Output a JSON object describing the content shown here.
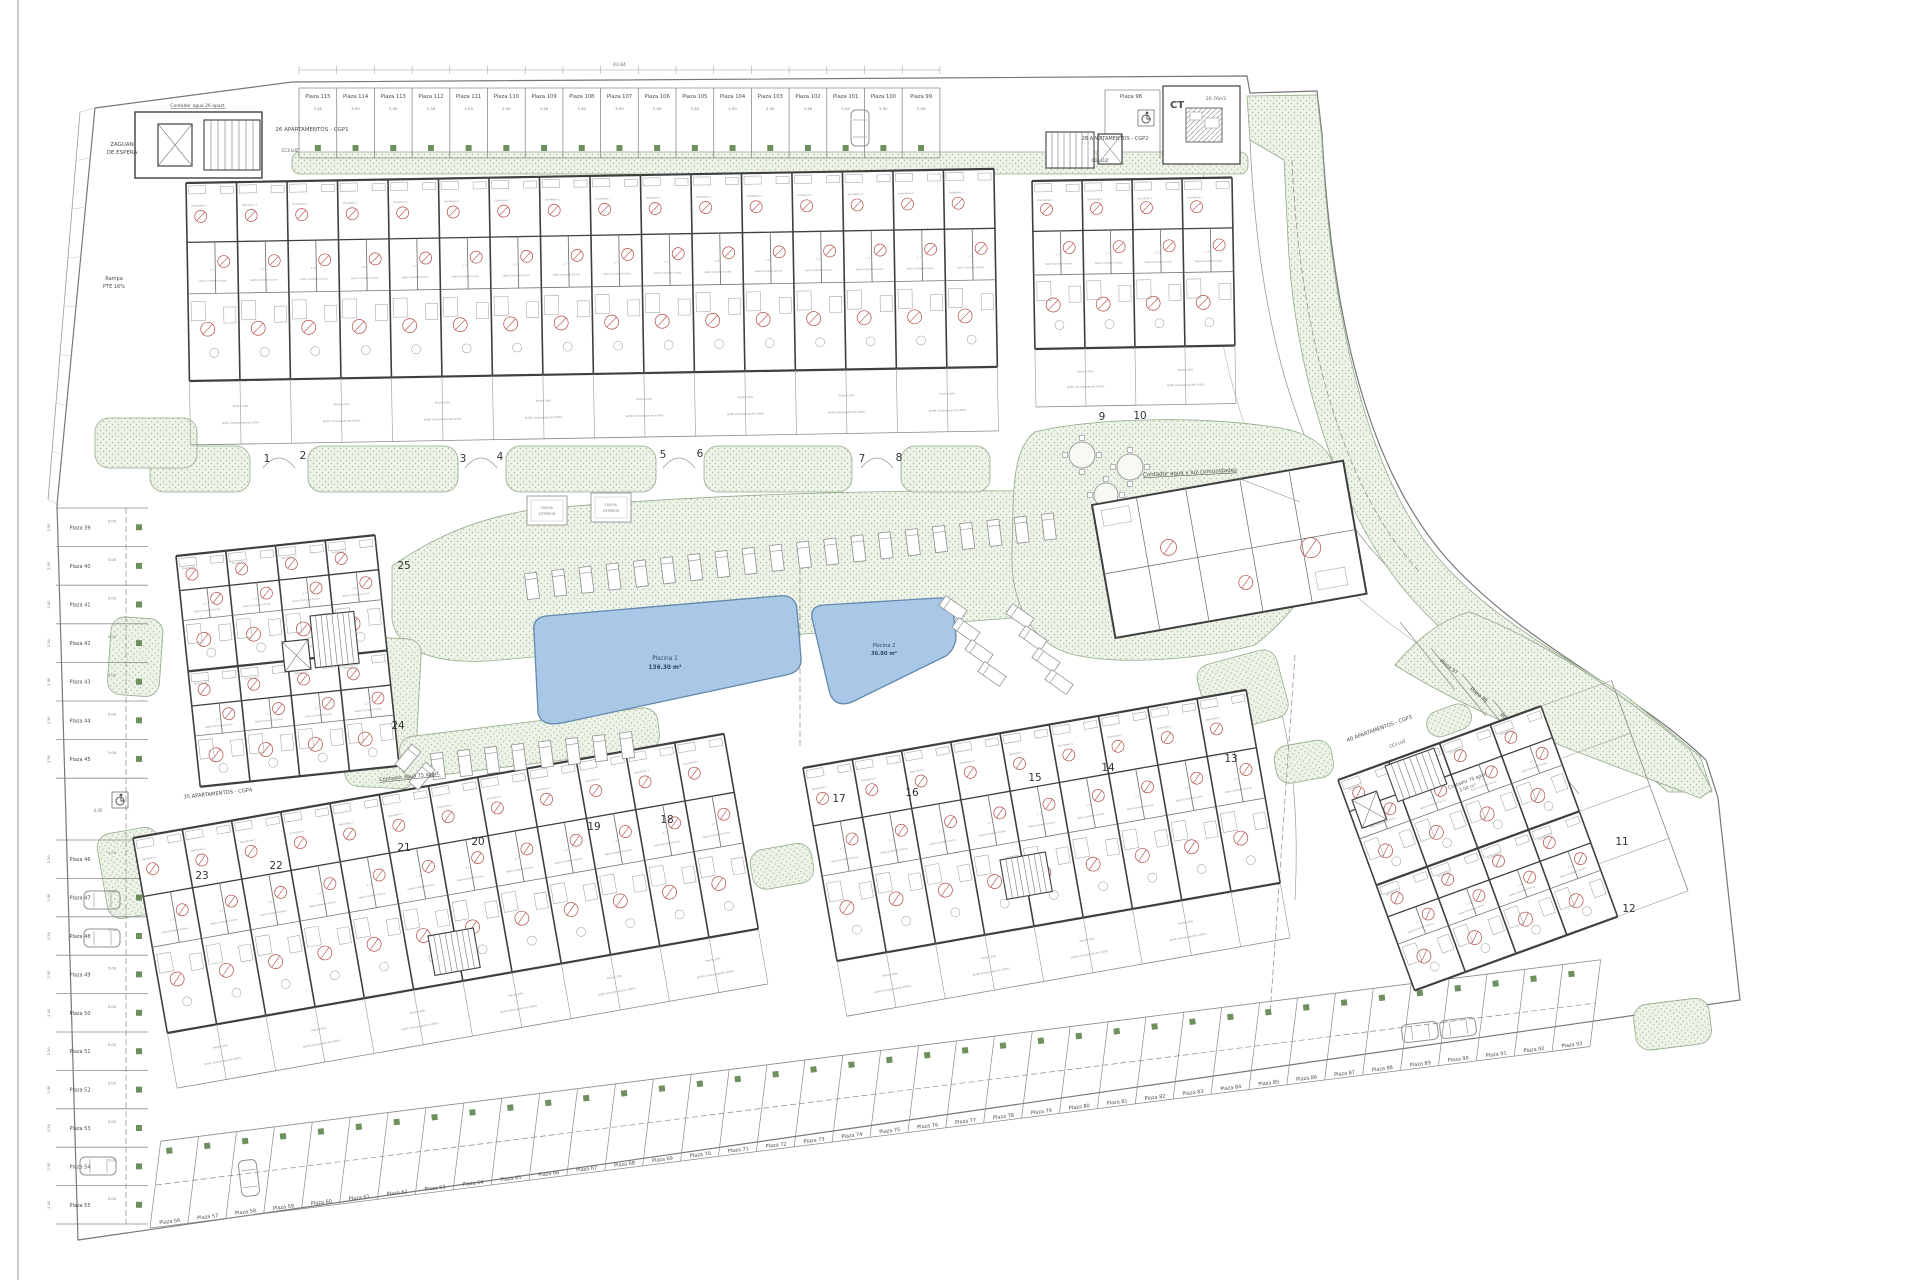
{
  "plan": {
    "labels": {
      "zaguan_line1": "ZAGUAN",
      "zaguan_line2": "DE ESPERA",
      "rampa_line1": "Rampa",
      "rampa_line2": "PTE 16%",
      "cgp1": "26 APARTAMENTOS - CGP1",
      "cgp2": "28 APARTAMENTOS - CGP2",
      "cgp3": "40 APARTAMENTOS - CGP3",
      "cgp4": "35 APARTAMENTOS - CGP4",
      "contador26": "Contador agua 26 apart.",
      "contador75": "Contador agua 75 apart.",
      "contador75b": "Contador 75 apart",
      "contador75b_area": "3.00 m²",
      "comunidades": "Contador agua y luz comunidades",
      "ct": "CT",
      "ct_area": "20.76m2",
      "cc3luz": "CC3 LUZ",
      "ducha_line1": "DUCHA",
      "ducha_line2": "EXTERIOR"
    },
    "pools": [
      {
        "name": "Piscina 1",
        "area": "136.30 m²"
      },
      {
        "name": "Piscina 2",
        "area": "36.80 m²"
      }
    ],
    "parking": {
      "top": [
        "Plaza 115",
        "Plaza 114",
        "Plaza 113",
        "Plaza 112",
        "Plaza 111",
        "Plaza 110",
        "Plaza 109",
        "Plaza 108",
        "Plaza 107",
        "Plaza 106",
        "Plaza 105",
        "Plaza 104",
        "Plaza 103",
        "Plaza 102",
        "Plaza 101",
        "Plaza 100",
        "Plaza 99"
      ],
      "isolated": "Plaza 98",
      "left": [
        "Plaza 39",
        "Plaza 40",
        "Plaza 41",
        "Plaza 42",
        "Plaza 43",
        "Plaza 44",
        "Plaza 45",
        "Plaza 46",
        "Plaza 47",
        "Plaza 48",
        "Plaza 49",
        "Plaza 50",
        "Plaza 51",
        "Plaza 52",
        "Plaza 53",
        "Plaza 54",
        "Plaza 55"
      ],
      "bottom": [
        "Plaza 56",
        "Plaza 57",
        "Plaza 58",
        "Plaza 59",
        "Plaza 60",
        "Plaza 61",
        "Plaza 62",
        "Plaza 63",
        "Plaza 64",
        "Plaza 65",
        "Plaza 66",
        "Plaza 67",
        "Plaza 68",
        "Plaza 69",
        "Plaza 70",
        "Plaza 71",
        "Plaza 72",
        "Plaza 73",
        "Plaza 74",
        "Plaza 75",
        "Plaza 76",
        "Plaza 77",
        "Plaza 78",
        "Plaza 79",
        "Plaza 80",
        "Plaza 81",
        "Plaza 82",
        "Plaza 83",
        "Plaza 84",
        "Plaza 85",
        "Plaza 86",
        "Plaza 87",
        "Plaza 88",
        "Plaza 89",
        "Plaza 90",
        "Plaza 91",
        "Plaza 92",
        "Plaza 93"
      ],
      "right": [
        "Plaza 97",
        "Plaza 96",
        "Plaza 95",
        "Plaza 94"
      ]
    },
    "units": {
      "top": [
        "1",
        "2",
        "3",
        "4",
        "5",
        "6",
        "7",
        "8"
      ],
      "top_right": [
        "9",
        "10"
      ],
      "left_block": [
        "25",
        "24"
      ],
      "bottom_left": [
        "23",
        "22",
        "21",
        "20",
        "19",
        "18"
      ],
      "bottom_middle": [
        "17",
        "16",
        "15",
        "14",
        "13"
      ],
      "right_block": [
        "11",
        "12"
      ]
    },
    "rooms": [
      {
        "name": "Dormitorio 1",
        "area": "9.00 m²"
      },
      {
        "name": "Dormitorio 2",
        "area": "10.70 m²"
      },
      {
        "name": "Dormitorio 3",
        "area": "11.90 m²"
      },
      {
        "name": "Salón-Comedor-Cocina",
        "area": "23.90 m²"
      },
      {
        "name": "Baño 1",
        "area": "3.90 m²"
      },
      {
        "name": "Baño 2",
        "area": "2.90 m²"
      },
      {
        "name": "Paso",
        "area": "4.00 m²"
      },
      {
        "name": "Porche 20%",
        "area": "4.35 m²"
      },
      {
        "name": "Jardín (incluye porche 100%)",
        "area": "36.70 m²"
      }
    ],
    "dims": {
      "stall_width": "2.50",
      "stall_depth": "5.00",
      "gap": "4.00",
      "sample1": "2.77",
      "sample2": "3.22",
      "total_top": "43.84"
    },
    "colors": {
      "green_fill": "#edf3e8",
      "green_dot": "#a8c29e",
      "green_edge": "#93ab89",
      "pool_fill": "#a9c8e7",
      "pool_edge": "#6288ab",
      "wall": "#3f3f3f",
      "line": "#8b8b8b",
      "red": "#b04a42",
      "tree_square": "#6e8f5e"
    }
  }
}
